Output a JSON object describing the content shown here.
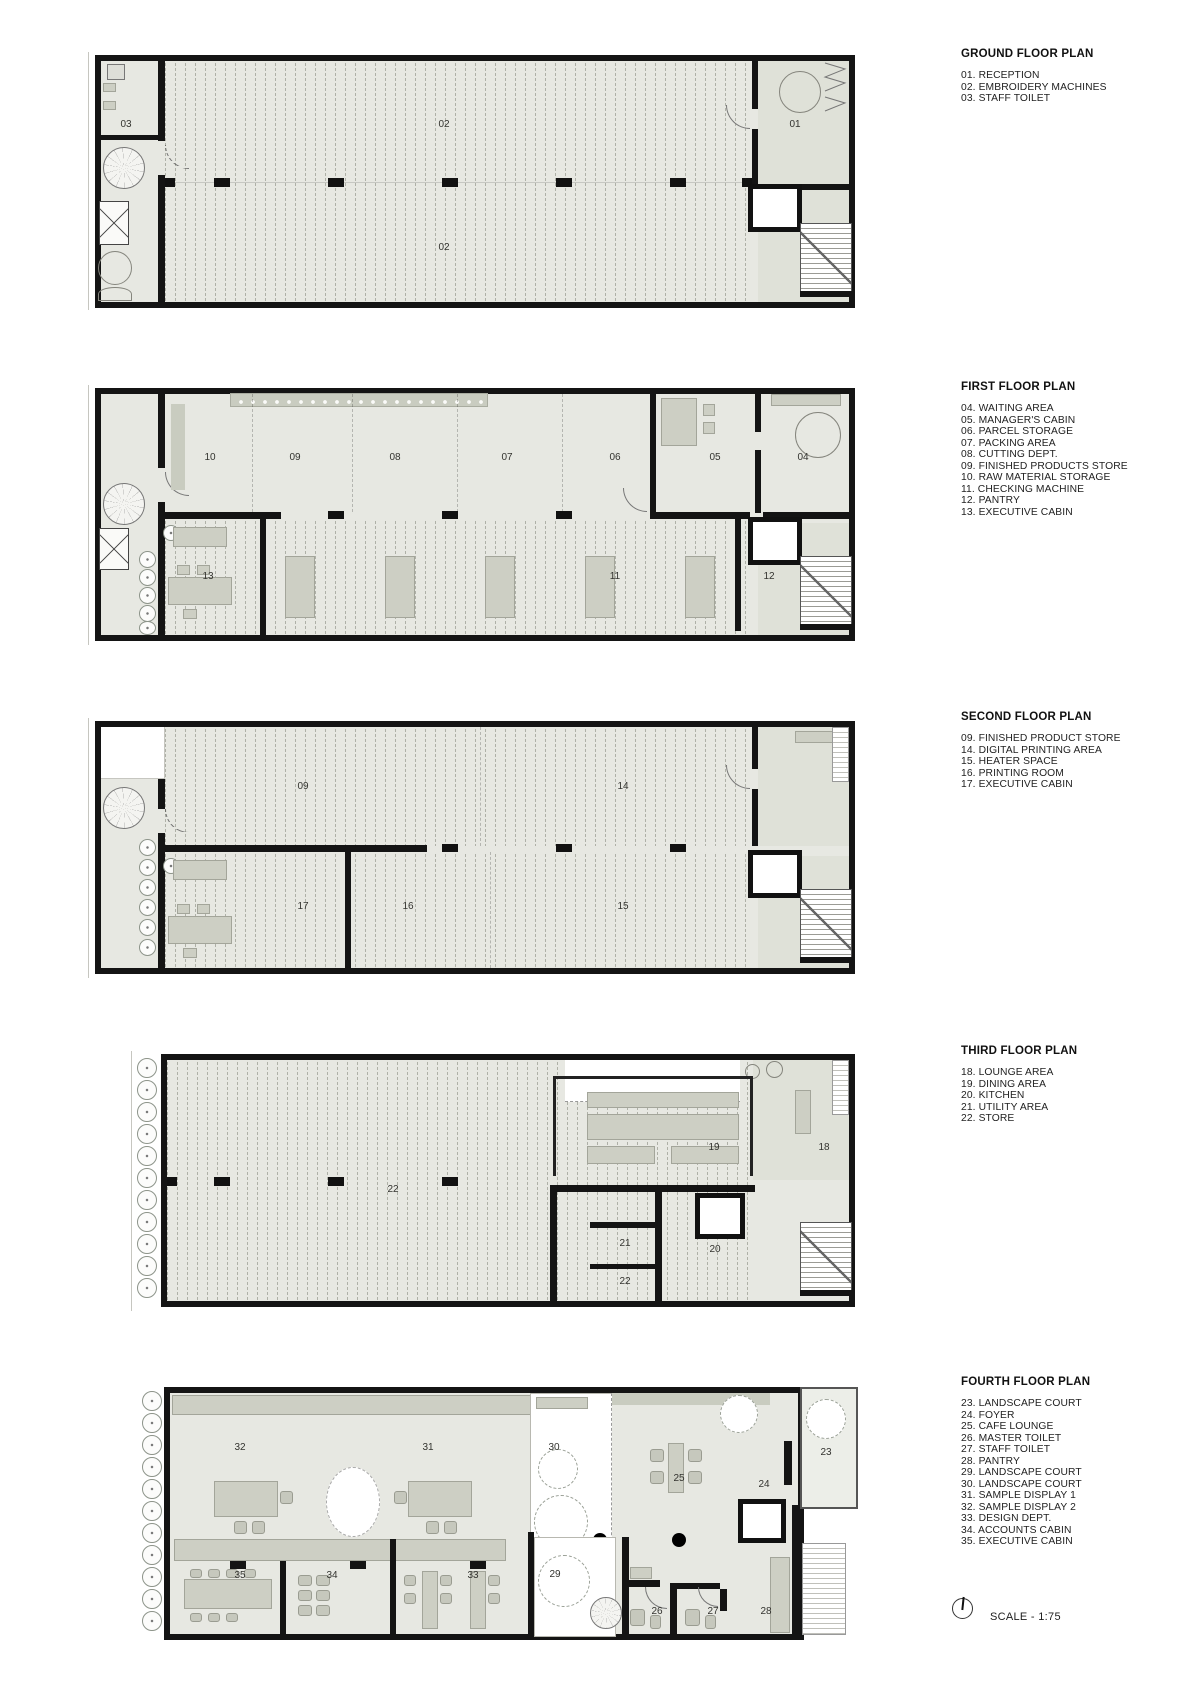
{
  "document": {
    "scale_note": "SCALE - 1:75"
  },
  "colors": {
    "wall": "#141414",
    "floor": "#e7e8e2",
    "floor_dark": "#dfe1d8",
    "furniture": "#cdcfc4",
    "text": "#1c1c1c"
  },
  "legend": [
    {
      "title": "GROUND FLOOR PLAN",
      "items": [
        "01. RECEPTION",
        "02. EMBROIDERY MACHINES",
        "03. STAFF TOILET"
      ]
    },
    {
      "title": "FIRST FLOOR PLAN",
      "items": [
        "04. WAITING AREA",
        "05. MANAGER'S CABIN",
        "06. PARCEL STORAGE",
        "07. PACKING AREA",
        "08. CUTTING DEPT.",
        "09. FINISHED PRODUCTS STORE",
        "10. RAW MATERIAL STORAGE",
        "11. CHECKING MACHINE",
        "12. PANTRY",
        "13. EXECUTIVE CABIN"
      ]
    },
    {
      "title": "SECOND FLOOR PLAN",
      "items": [
        "09. FINISHED PRODUCT STORE",
        "14. DIGITAL PRINTING AREA",
        "15. HEATER SPACE",
        "16. PRINTING ROOM",
        "17. EXECUTIVE CABIN"
      ]
    },
    {
      "title": "THIRD FLOOR PLAN",
      "items": [
        "18. LOUNGE AREA",
        "19. DINING AREA",
        "20. KITCHEN",
        "21. UTILITY AREA",
        "22. STORE"
      ]
    },
    {
      "title": "FOURTH FLOOR PLAN",
      "items": [
        "23. LANDSCAPE COURT",
        "24. FOYER",
        "25. CAFE LOUNGE",
        "26. MASTER TOILET",
        "27. STAFF TOILET",
        "28. PANTRY",
        "29. LANDSCAPE COURT",
        "30. LANDSCAPE COURT",
        "31. SAMPLE DISPLAY 1",
        "32. SAMPLE DISPLAY 2",
        "33. DESIGN DEPT.",
        "34. ACCOUNTS CABIN",
        "35. EXECUTIVE CABIN"
      ]
    }
  ],
  "plans": [
    {
      "name": "ground-floor-plan",
      "room_labels": [
        "03",
        "02",
        "01",
        "02"
      ]
    },
    {
      "name": "first-floor-plan",
      "room_labels": [
        "10",
        "09",
        "08",
        "07",
        "06",
        "05",
        "04",
        "13",
        "11",
        "12"
      ]
    },
    {
      "name": "second-floor-plan",
      "room_labels": [
        "09",
        "14",
        "17",
        "16",
        "15"
      ]
    },
    {
      "name": "third-floor-plan",
      "room_labels": [
        "22",
        "19",
        "18",
        "21",
        "20",
        "22"
      ]
    },
    {
      "name": "fourth-floor-plan",
      "room_labels": [
        "32",
        "31",
        "30",
        "23",
        "25",
        "24",
        "35",
        "34",
        "33",
        "29",
        "26",
        "27",
        "28"
      ]
    }
  ]
}
